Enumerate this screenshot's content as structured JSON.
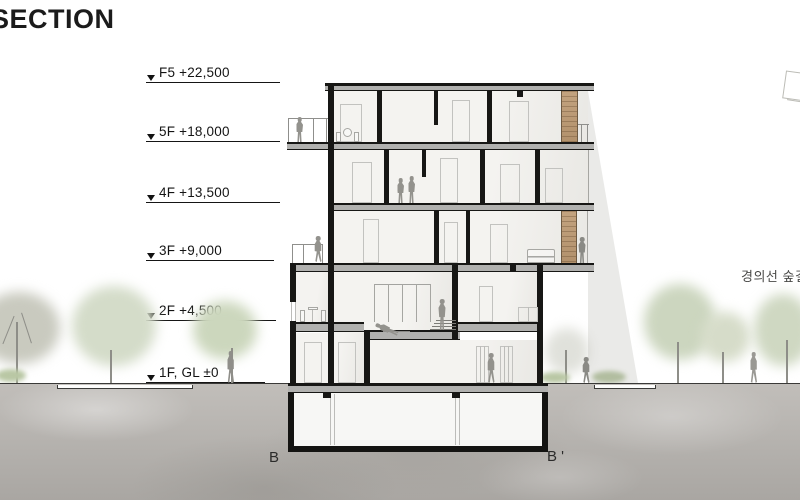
{
  "title": "SECTION",
  "levels": [
    {
      "label": "F5 +22,500"
    },
    {
      "label": "5F +18,000"
    },
    {
      "label": "4F +13,500"
    },
    {
      "label": "3F +9,000"
    },
    {
      "label": "2F +4,500"
    },
    {
      "label": "1F, GL ±0"
    }
  ],
  "annotations": {
    "right_label": "경의선 숲길"
  },
  "section_markers": {
    "start": "B",
    "end": "B '"
  },
  "colors": {
    "wall_cut": "#171715",
    "slab": "#b1b1af",
    "ground": "#b4b1ad",
    "wood_panel": "#bd9d7c",
    "tree_foliage": "#ccd6bf",
    "figure": "#93928d"
  }
}
